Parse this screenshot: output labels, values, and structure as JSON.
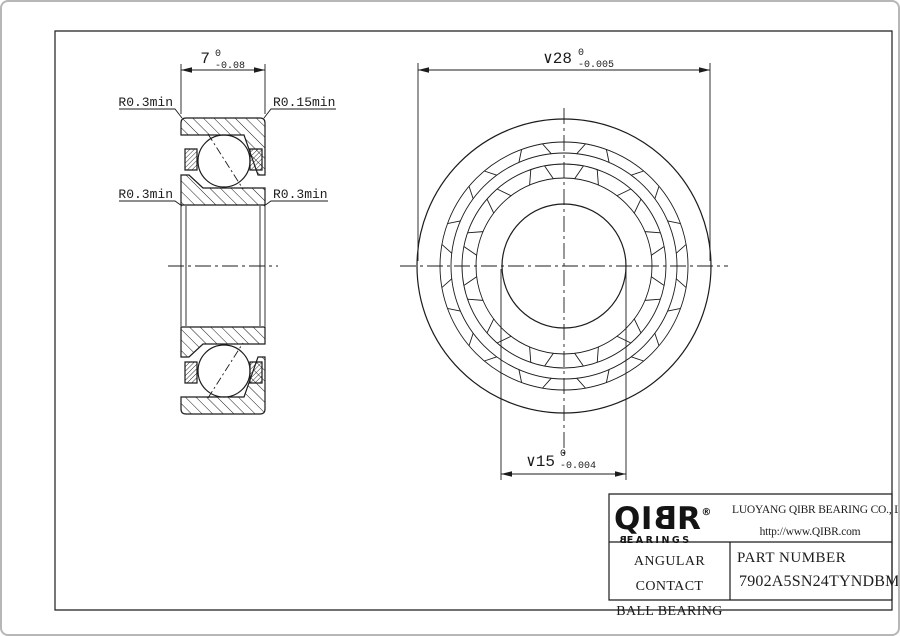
{
  "page": {
    "background": "#ffffff",
    "line_color": "#1c1c1c",
    "border_color": "#b7b7b7"
  },
  "section_view": {
    "width_dimension": {
      "value": "7",
      "tol_upper": "0",
      "tol_lower": "-0.08"
    },
    "fillet_labels": {
      "top_left": "R0.3min",
      "top_right": "R0.15min",
      "bottom_left": "R0.3min",
      "bottom_right": "R0.3min"
    }
  },
  "front_view": {
    "outer_diameter_dimension": {
      "value": "∨28",
      "tol_upper": "0",
      "tol_lower": "-0.005"
    },
    "bore_diameter_dimension": {
      "value": "∨15",
      "tol_upper": "0",
      "tol_lower": "-0.004"
    }
  },
  "title_block": {
    "logo": {
      "part1": "QI",
      "mirrored_b": "B",
      "part2": "R",
      "registered": "®",
      "subtitle_b": "B",
      "subtitle_rest": "EARINGS"
    },
    "company_name": "LUOYANG QIBR BEARING CO., LTD",
    "website": "http://www.QIBR.com",
    "product_type_line1": "ANGULAR CONTACT",
    "product_type_line2": "BALL BEARING",
    "part_number_label": "PART NUMBER",
    "part_number": "7902A5SN24TYNDBMP4"
  }
}
